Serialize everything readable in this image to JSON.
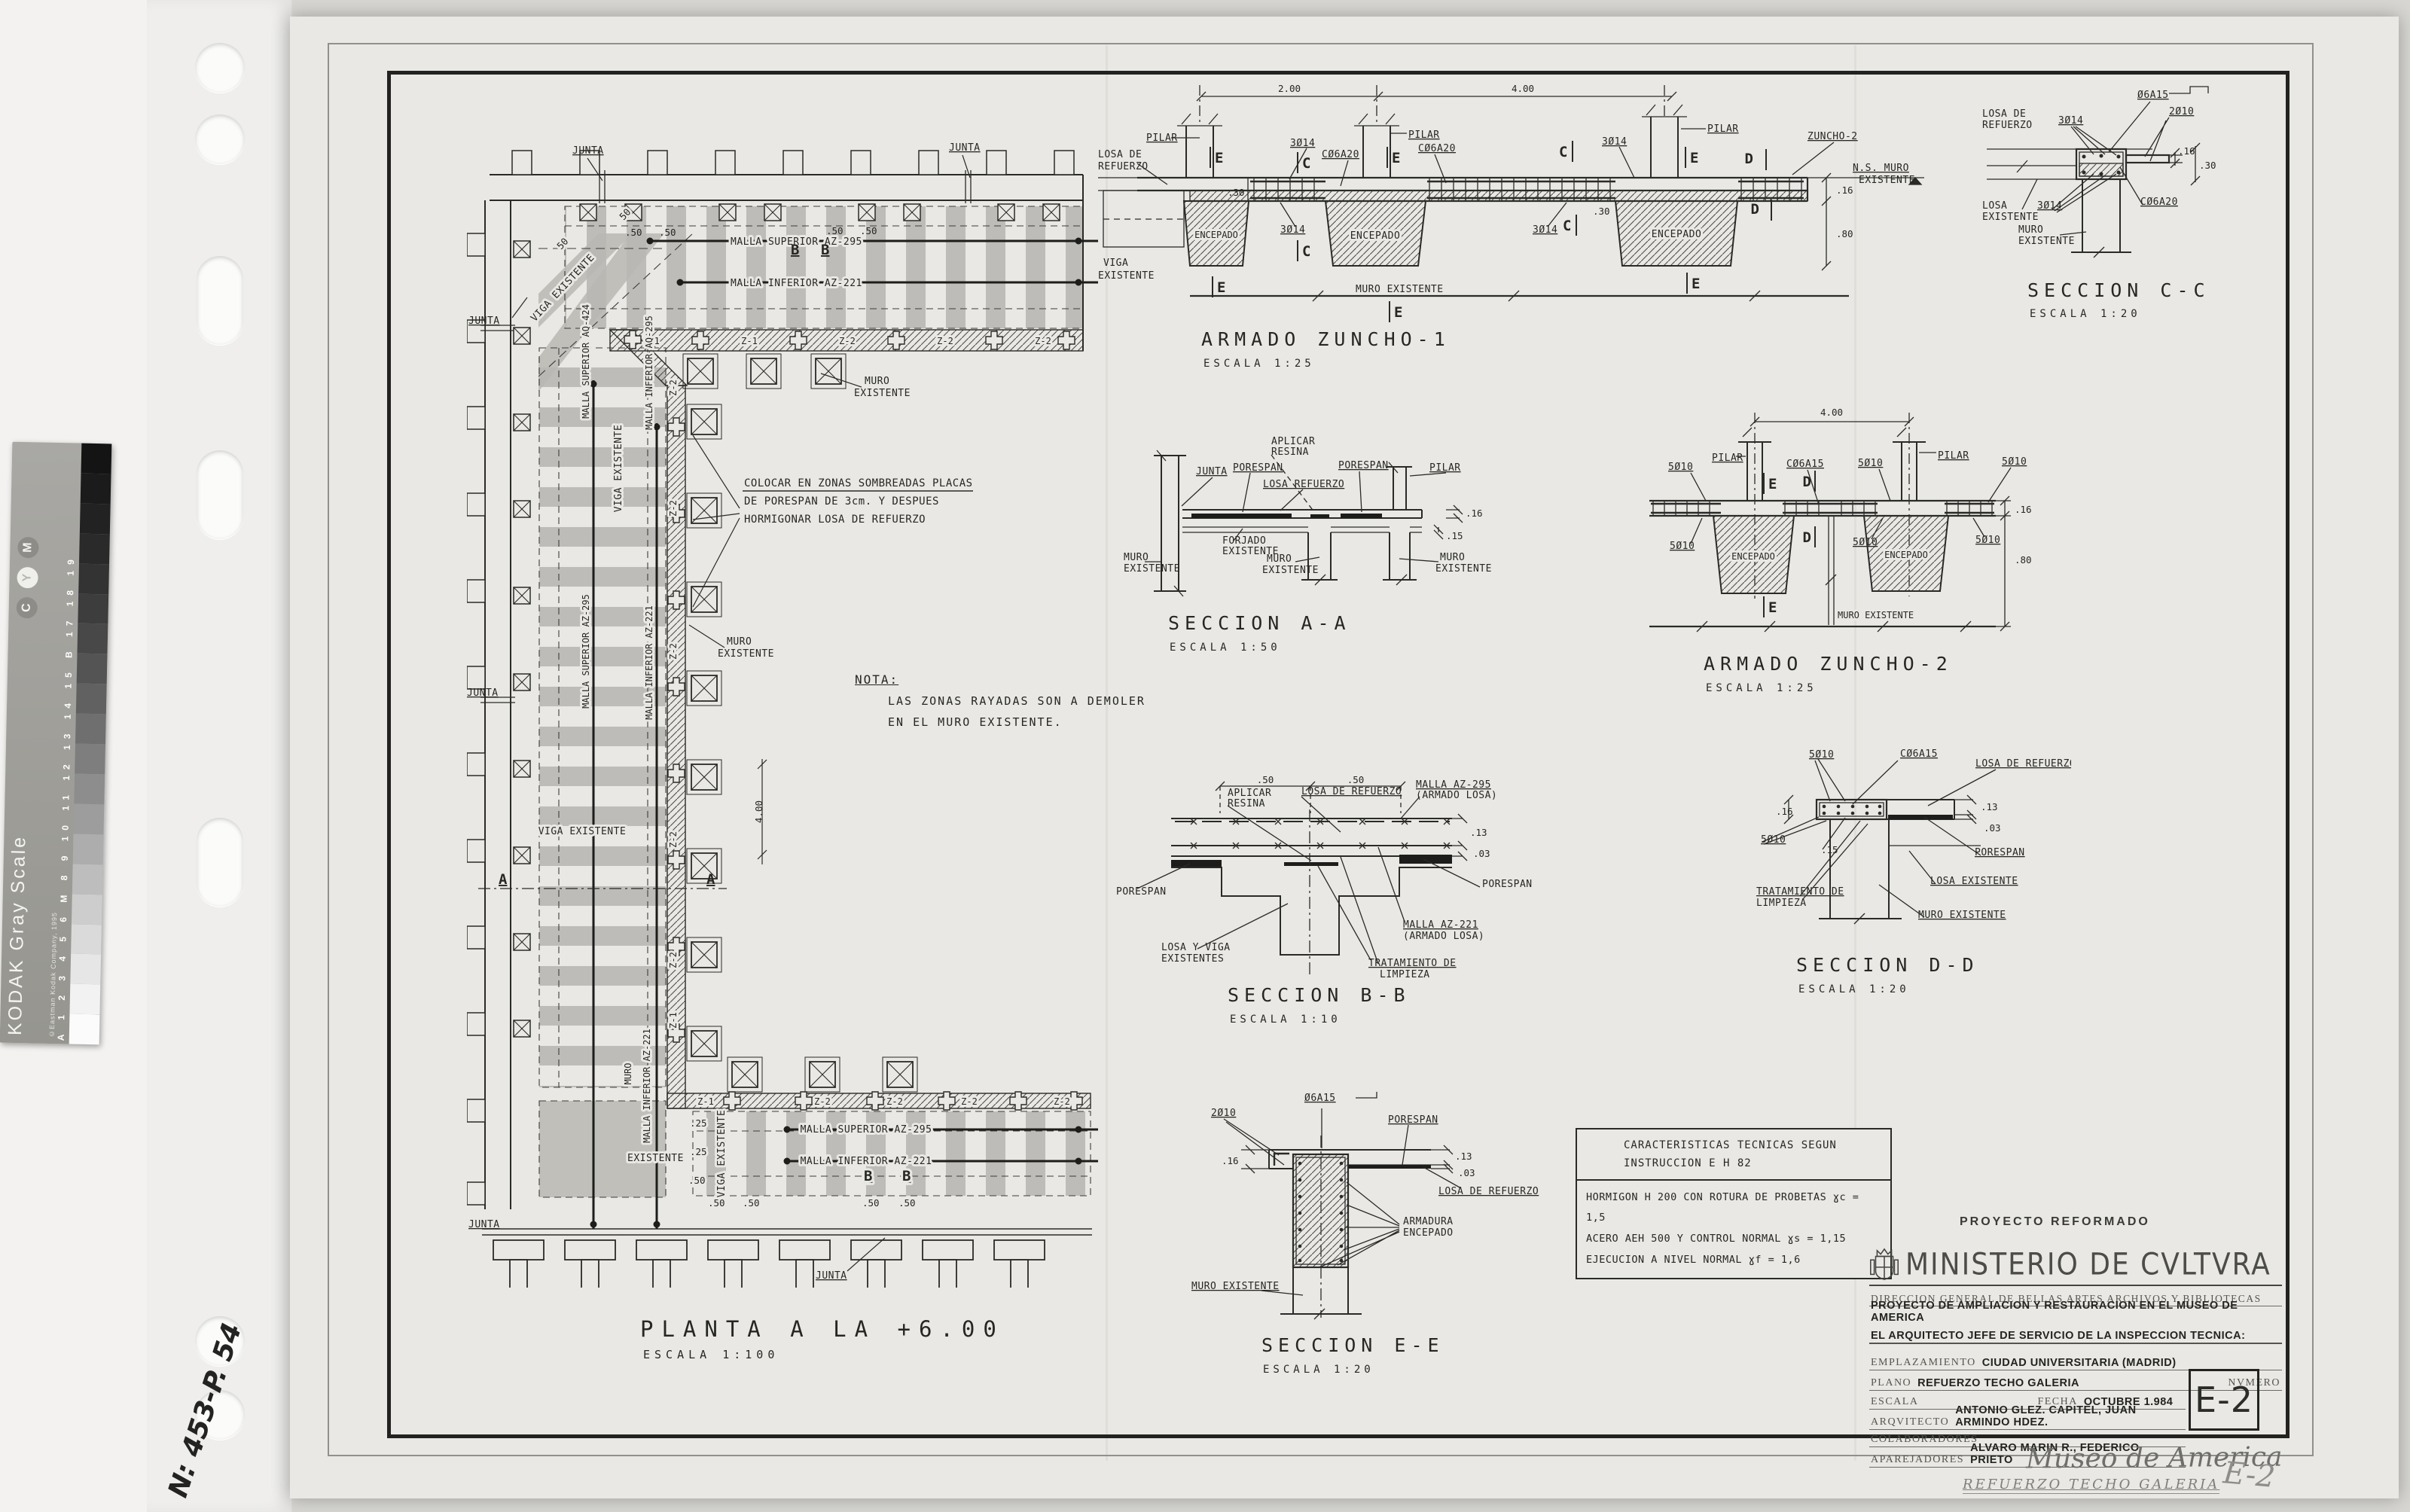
{
  "colors": {
    "paper": "#e9e8e4",
    "ink": "#262624",
    "shade": "#b8b7b3"
  },
  "t": {
    "junta": "JUNTA",
    "pilar": "PILAR",
    "encepado": "ENCEPADO",
    "porespan": "PORESPAN",
    "muro": "MURO",
    "existente": "EXISTENTE",
    "existentes": "EXISTENTES",
    "muro_existente": "MURO EXISTENTE",
    "ns_muro": "N.S. MURO",
    "losa_de": "LOSA DE",
    "refuerzo": "REFUERZO",
    "losa_de_refuerzo": "LOSA DE REFUERZO",
    "losa": "LOSA",
    "losa_existente": "LOSA EXISTENTE",
    "losa_refuerzo": "LOSA REFUERZO",
    "losa_y_viga": "LOSA Y VIGA",
    "viga": "VIGA",
    "viga_existente": "VIGA EXISTENTE",
    "forjado": "FORJADO",
    "aplicar": "APLICAR",
    "resina": "RESINA",
    "tratamiento_de": "TRATAMIENTO DE",
    "limpieza": "LIMPIEZA",
    "armadura": "ARMADURA",
    "zuncho2_ref": "ZUNCHO-2",
    "malla_az295": "MALLA AZ-295",
    "malla_az221": "MALLA AZ-221",
    "armado_losa": "(ARMADO LOSA)",
    "malla_sup_az295": "MALLA SUPERIOR AZ-295",
    "malla_inf_az221": "MALLA INFERIOR AZ-221",
    "malla_sup_aq424": "MALLA SUPERIOR AQ-424",
    "malla_inf_aq295": "MALLA INFERIOR AQ-295",
    "b3014": "3Ø14",
    "c06a20": "CØ6A20",
    "b5010": "5Ø10",
    "c06a15": "CØ6A15",
    "b06a15": "Ø6A15",
    "b2010": "2Ø10",
    "d200": "2.00",
    "d400": "4.00",
    "d30": ".30",
    "d16": ".16",
    "d80": ".80",
    "d50": ".50",
    "d25": ".25",
    "d13": ".13",
    "d03": ".03",
    "d15": ".15",
    "d50p": "50",
    "mE": "E",
    "mC": "C",
    "mD": "D",
    "mA": "A",
    "mB": "B",
    "z1": "Z-1",
    "z2": "Z-2"
  },
  "plan": {
    "title": "PLANTA A LA +6.00",
    "scale": "ESCALA 1:100",
    "colocar": [
      "COLOCAR EN ZONAS SOMBREADAS PLACAS",
      "DE PORESPAN DE 3cm. Y DESPUES",
      "HORMIGONAR LOSA DE REFUERZO"
    ]
  },
  "nota": {
    "head": "NOTA:",
    "l1": "LAS ZONAS RAYADAS SON A DEMOLER",
    "l2": "EN EL MURO EXISTENTE."
  },
  "sec": {
    "z1": {
      "title": "ARMADO ZUNCHO-1",
      "scale": "ESCALA 1:25"
    },
    "z2": {
      "title": "ARMADO ZUNCHO-2",
      "scale": "ESCALA 1:25"
    },
    "aa": {
      "title": "SECCION A-A",
      "scale": "ESCALA 1:50"
    },
    "bb": {
      "title": "SECCION B-B",
      "scale": "ESCALA 1:10"
    },
    "cc": {
      "title": "SECCION C-C",
      "scale": "ESCALA 1:20"
    },
    "dd": {
      "title": "SECCION D-D",
      "scale": "ESCALA 1:20"
    },
    "ee": {
      "title": "SECCION E-E",
      "scale": "ESCALA 1:20"
    }
  },
  "tech": {
    "h1": "CARACTERISTICAS TECNICAS SEGUN",
    "h2": "INSTRUCCION E H 82",
    "l1": "HORMIGON H 200 CON ROTURA DE PROBETAS ɣc = 1,5",
    "l2": "ACERO AEH 500 Y CONTROL NORMAL ɣs = 1,15",
    "l3": "EJECUCION A NIVEL NORMAL ɣf = 1,6"
  },
  "stamp": "PROYECTO REFORMADO",
  "tb": {
    "ministry": "MINISTERIO DE CVLTVRA",
    "direccion": "DIRECCION GENERAL DE BELLAS ARTES ARCHIVOS Y BIBLIOTECAS",
    "proyecto": "PROYECTO DE AMPLIACION Y RESTAURACION EN EL MUSEO DE AMERICA",
    "jefe": "EL ARQUITECTO JEFE DE SERVICIO DE LA INSPECCION TECNICA:",
    "emplazamiento_label": "EMPLAZAMIENTO",
    "emplazamiento": "CIUDAD UNIVERSITARIA    (MADRID)",
    "plano_label": "PLANO",
    "plano": "REFUERZO TECHO GALERIA",
    "numero_label": "NVMERO",
    "escala_label": "ESCALA",
    "fecha_label": "FECHA",
    "fecha": "OCTUBRE  1.984",
    "arquitecto_label": "ARQVITECTO",
    "arquitecto": "ANTONIO GLEZ. CAPITEL, JUAN ARMINDO HDEZ.",
    "colaboradores_label": "COLABORADORES",
    "aparejadores_label": "APAREJADORES",
    "aparejadores": "ALVARO MARIN R., FEDERICO PRIETO",
    "numero": "E-2"
  },
  "hand": {
    "museum": "Museo de America",
    "plano": "REFUERZO TECHO GALERIA",
    "num": "E-2",
    "film": "N: 453-P. 54"
  },
  "kodak": {
    "brand": "KODAK Gray Scale",
    "copy": "©Eastman Kodak Company, 1995",
    "rail": "A 1 2 3 4 5 6 M 8 9 10 11 12 13 14 15 B 17 18 19",
    "c": "C",
    "y": "Y",
    "m": "M",
    "steps": [
      "#141414",
      "#1b1b1b",
      "#222222",
      "#2a2a2a",
      "#333333",
      "#3d3d3d",
      "#484848",
      "#545454",
      "#616161",
      "#6f6f6f",
      "#7e7e7e",
      "#8d8d8d",
      "#9d9d9d",
      "#adadad",
      "#bdbdbd",
      "#cdcdcd",
      "#dadada",
      "#e6e6e6",
      "#f2f2f2",
      "#fbfbfb"
    ]
  }
}
